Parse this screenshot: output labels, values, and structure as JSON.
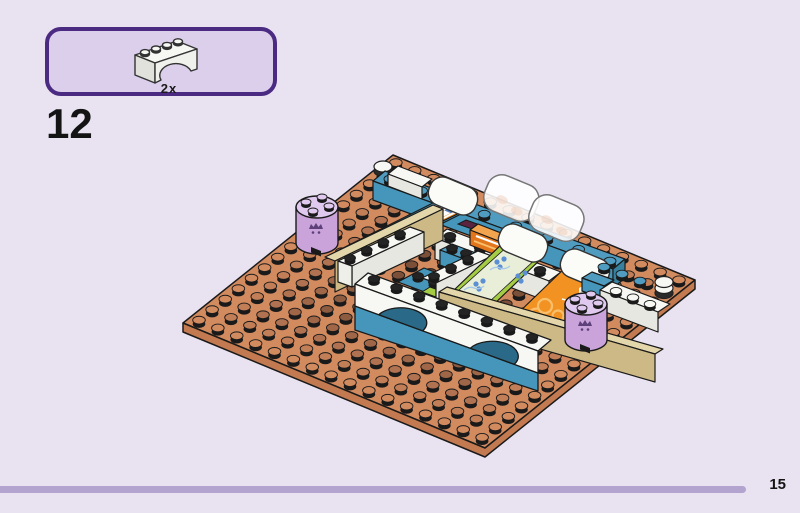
{
  "page": {
    "background": "#e9e3f1",
    "step_number": "12",
    "page_number": "15",
    "footer_line_color": "#b3a3cf"
  },
  "parts_box": {
    "quantity": "2x",
    "part": "arch-brick-1x4-white",
    "border_color": "#4b2a82",
    "fill": "#dccfeb"
  },
  "assembly": {
    "description": "Isometric view: place the two white 1x4 arch bricks on the front of the supermarket shelf structure built on a 16x16 nougat baseplate",
    "baseplate": {
      "studs_x": 16,
      "studs_y": 16
    },
    "parts_visible": [
      "nougat baseplate 16x16",
      "white arch brick 1x4 (x2, new in this step)",
      "azure blue wall bricks",
      "white wall bricks with studs",
      "checkout conveyor with blue-white checkered belt",
      "orange cash-register brick",
      "green printed shelf slope with flower pattern",
      "orange printed shelf slope",
      "white curved slope bricks",
      "transparent curved panels",
      "tan shelf walls",
      "lavender round brick 2x2 with print (x2)",
      "white round tiles",
      "white counter with studs"
    ],
    "colors": {
      "outline": "#1a1a1a",
      "plate_top": "#d28a5f",
      "plate_side": "#c37a50",
      "stud_dark": "#6b4331",
      "stud_black": "#1a1a1a",
      "teal": "#4596ba",
      "teal_top": "#4f9cc0",
      "teal_dark": "#37819f",
      "teal_shadow": "#2a6a88",
      "white_top": "#f7f7f4",
      "white_side": "#e7e7e2",
      "white_dim": "#efefea",
      "tan_face": "#cdb985",
      "tan_top": "#e3d6ab",
      "lavender": "#c9a3da",
      "lavender_top": "#dfc9ef",
      "print_purple": "#5d3f7a",
      "lime": "#a5cc45",
      "lime_pale": "#e9eed8",
      "flower_blue": "#5b8fd4",
      "orange_tile": "#f29222",
      "orange_pattern": "#f8c06c",
      "belt_orange": "#e8831f",
      "checker_blue": "#4e7fd0",
      "register_orange": "#e2761c",
      "register_top": "#f2a44e"
    }
  }
}
